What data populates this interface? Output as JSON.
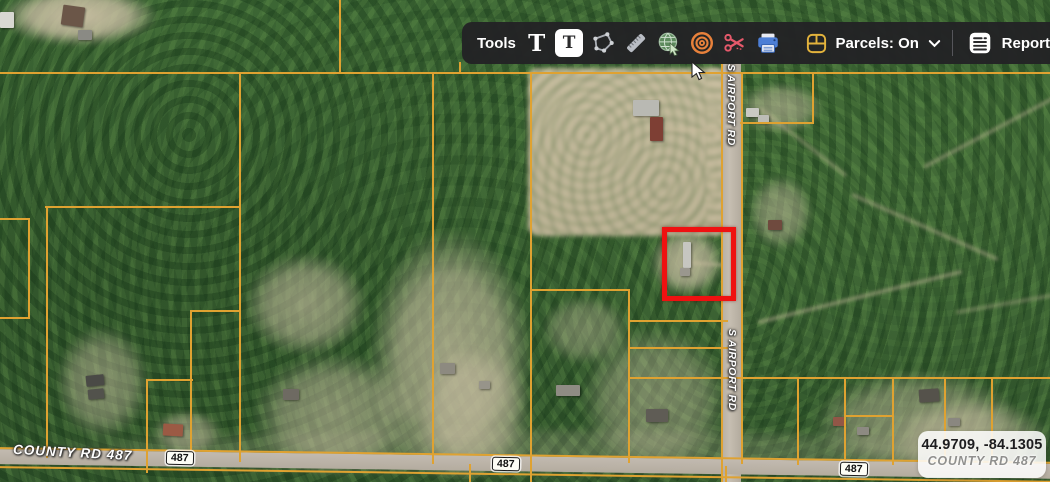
{
  "toolbar": {
    "tools_label": "Tools",
    "buttons": [
      {
        "name": "text-tool-icon",
        "tooltip": "Text"
      },
      {
        "name": "text-box-tool-icon",
        "tooltip": "Text box",
        "active": true
      },
      {
        "name": "polygon-draw-tool-icon",
        "tooltip": "Draw polygon"
      },
      {
        "name": "measure-tool-icon",
        "tooltip": "Measure"
      },
      {
        "name": "web-globe-tool-icon",
        "tooltip": "Web map"
      },
      {
        "name": "radius-tool-icon",
        "tooltip": "Radius"
      },
      {
        "name": "cut-tool-icon",
        "tooltip": "Cut"
      },
      {
        "name": "print-tool-icon",
        "tooltip": "Print"
      }
    ],
    "parcels_toggle": {
      "label": "Parcels: On",
      "icon": "parcels-icon",
      "chevron": "chevron-down-icon"
    },
    "report": {
      "label": "Report",
      "icon": "report-icon"
    }
  },
  "map": {
    "labels": {
      "airport_road": "S AIRPORT RD",
      "county_road": "COUNTY RD 487",
      "route_shield": "487"
    },
    "parcel_line_color": "#dfa231",
    "highlight_color": "#ef1111"
  },
  "status": {
    "coordinates": "44.9709, -84.1305",
    "road_label": "COUNTY RD 487"
  }
}
